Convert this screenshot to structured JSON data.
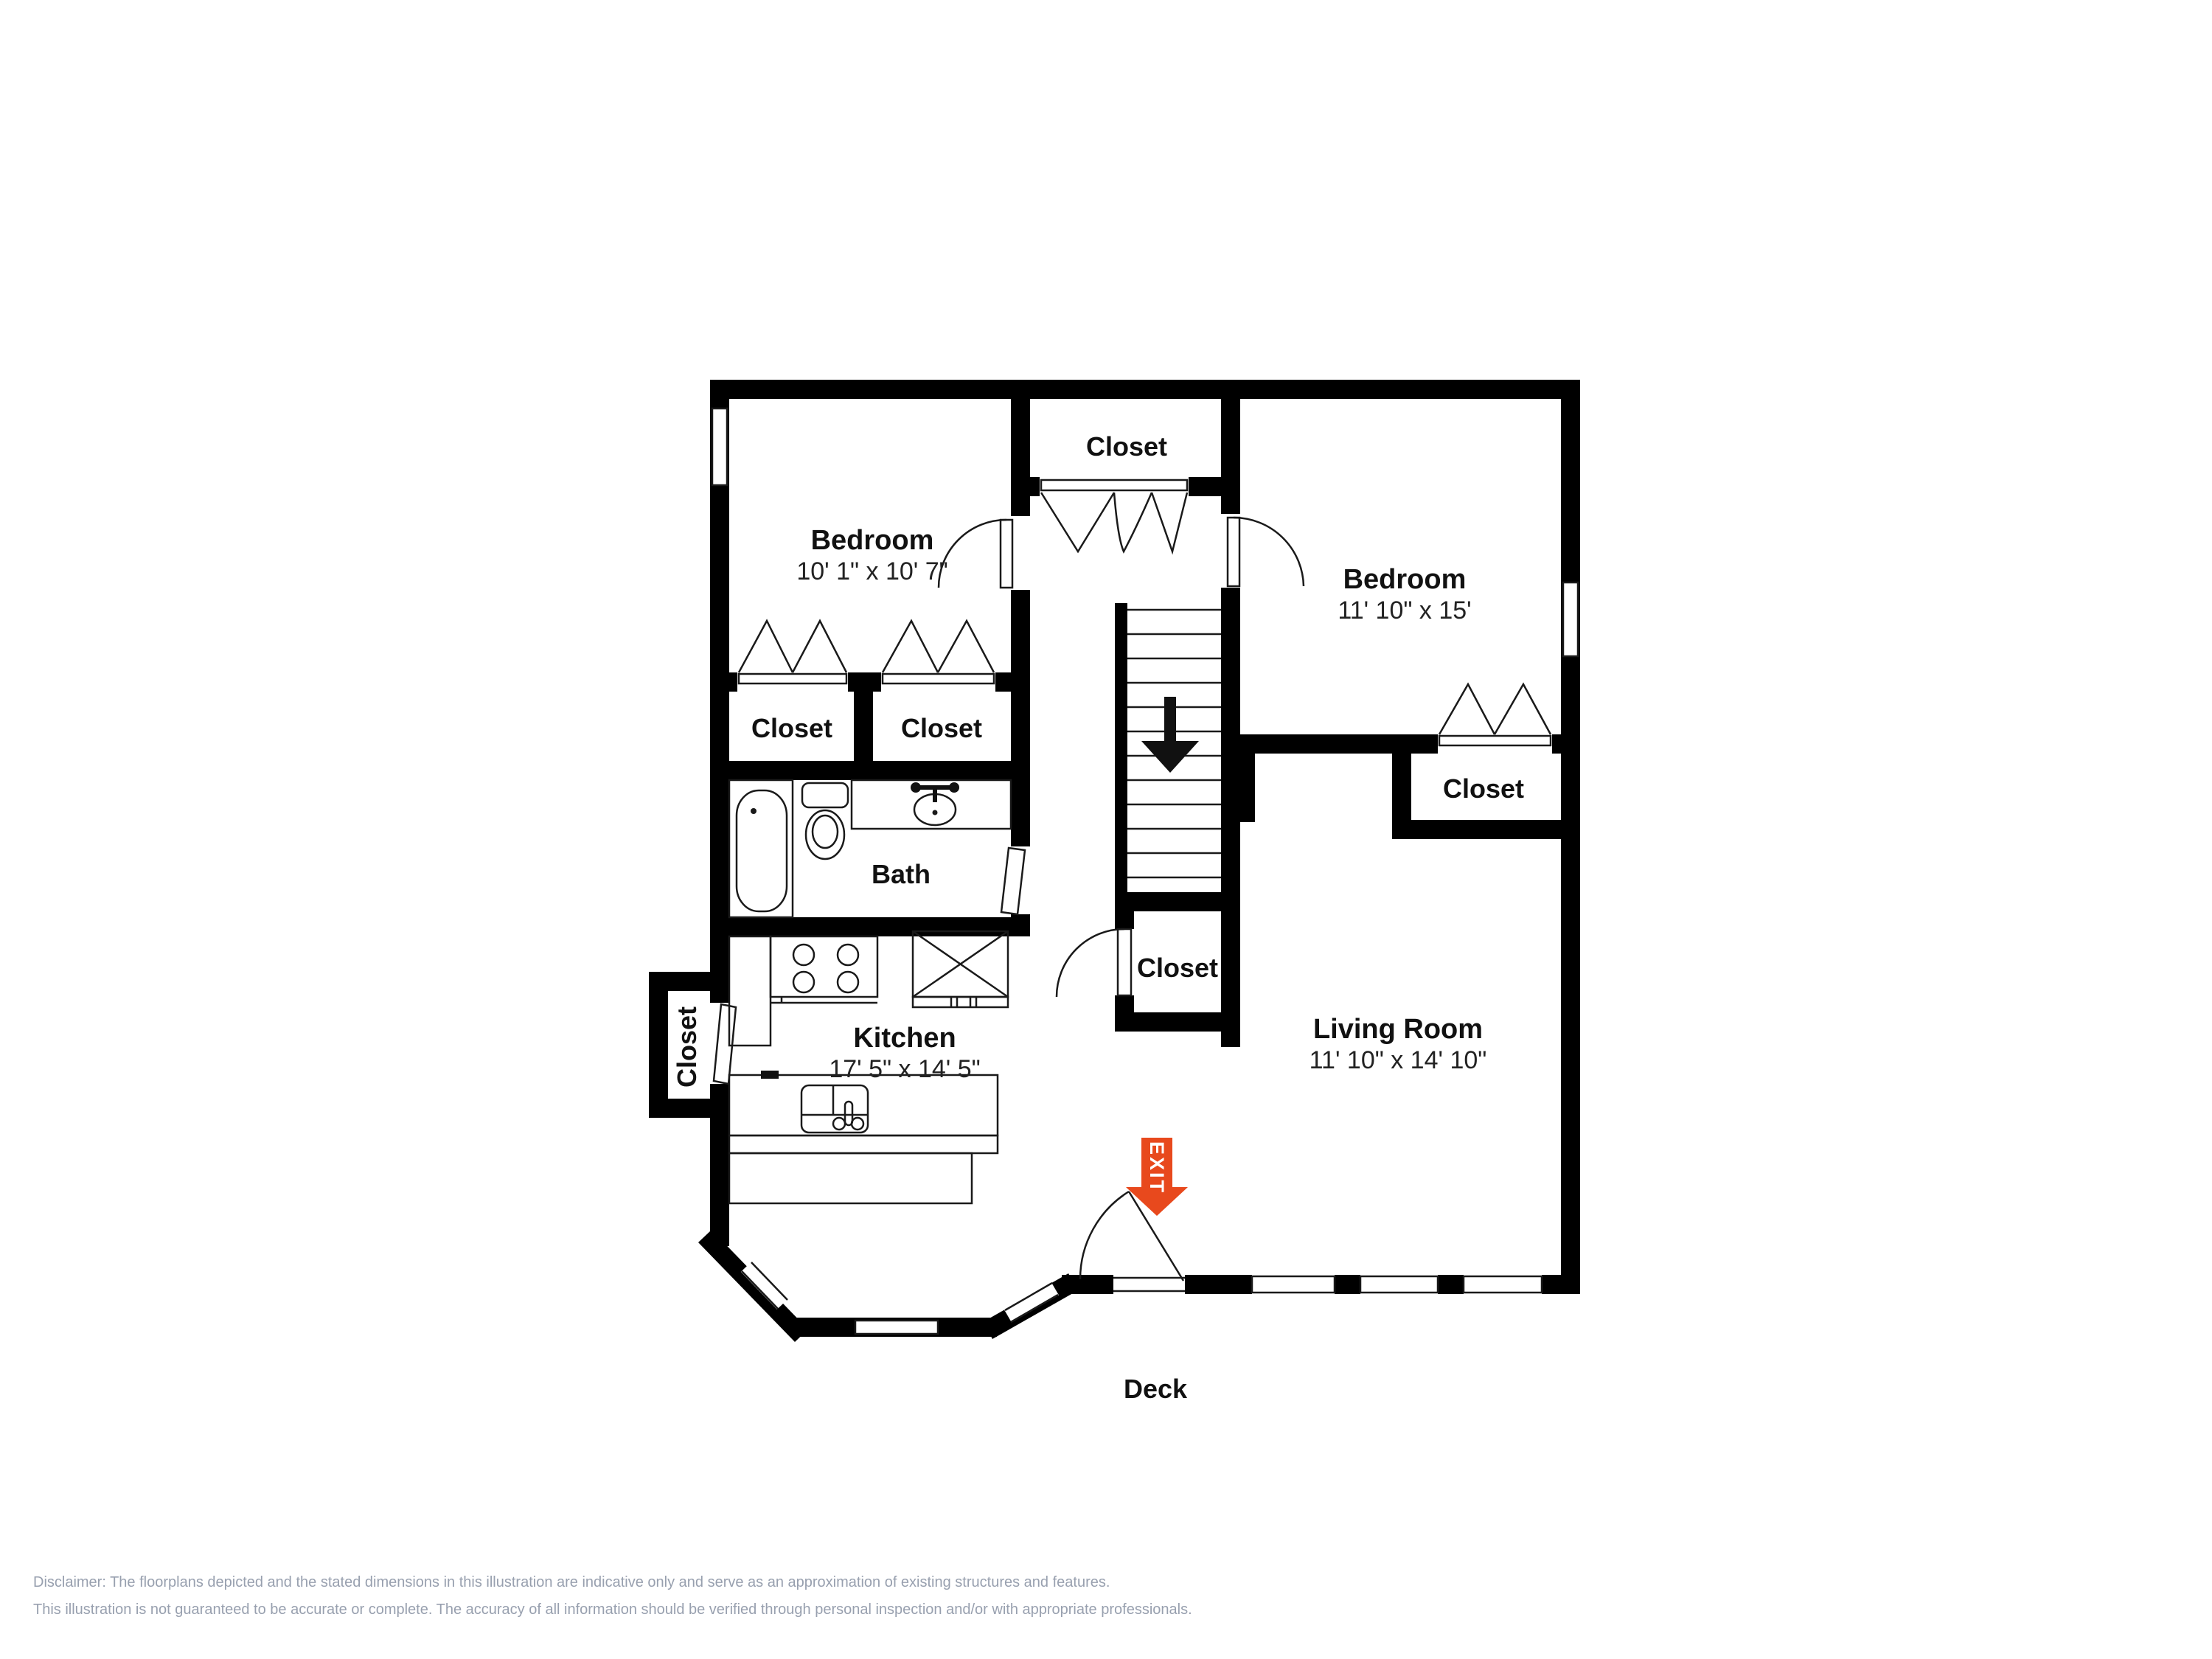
{
  "plan": {
    "rooms": {
      "bedroom_left": {
        "name": "Bedroom",
        "dims": "10' 1\" x 10' 7\""
      },
      "bedroom_right": {
        "name": "Bedroom",
        "dims": "11' 10\" x 15'"
      },
      "kitchen": {
        "name": "Kitchen",
        "dims": "17' 5\" x 14' 5\""
      },
      "living_room": {
        "name": "Living Room",
        "dims": "11' 10\" x 14' 10\""
      },
      "bath": {
        "name": "Bath"
      },
      "deck": {
        "name": "Deck"
      },
      "closet_top": {
        "name": "Closet"
      },
      "closet_left_1": {
        "name": "Closet"
      },
      "closet_left_2": {
        "name": "Closet"
      },
      "closet_right_bedroom": {
        "name": "Closet"
      },
      "closet_under_stairs": {
        "name": "Closet"
      },
      "closet_kitchen": {
        "name": "Closet"
      }
    },
    "exit_label": "EXIT",
    "colors": {
      "wall": "#000000",
      "exit_arrow": "#E8491D",
      "disclaimer_text": "#98A0AF"
    }
  },
  "disclaimer": {
    "line1": "Disclaimer: The floorplans depicted and the stated dimensions in this illustration are indicative only and serve as an approximation of existing structures and features.",
    "line2": "This illustration is not guaranteed to be accurate or complete. The accuracy of all information should be verified through personal inspection and/or with appropriate professionals."
  }
}
